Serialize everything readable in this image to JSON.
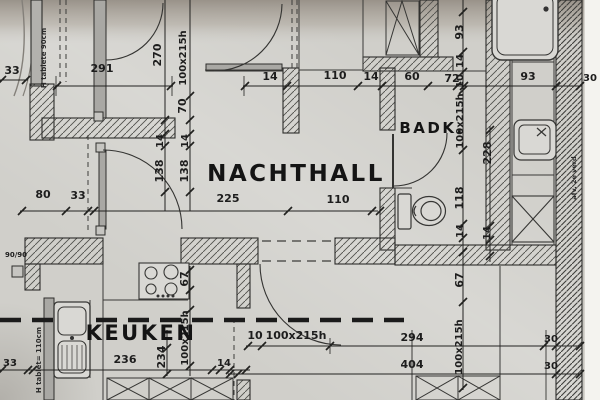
{
  "document": {
    "kind": "architectural floor plan (photo of printed drawing)",
    "colors": {
      "paper": "#d0cfca",
      "lines": "#2b2b2b",
      "shadow": "#9c978f",
      "paper_edge": "#f4f3ef"
    }
  },
  "rooms": [
    {
      "t": "NACHTHALL",
      "x": 296,
      "y": 181,
      "s": 23
    },
    {
      "t": "BADK.",
      "x": 432,
      "y": 133,
      "s": 15
    },
    {
      "t": "KEUKEN",
      "x": 141,
      "y": 340,
      "s": 21
    }
  ],
  "dimensions": [
    {
      "t": "33",
      "x": 12,
      "y": 74
    },
    {
      "t": "291",
      "x": 102,
      "y": 72
    },
    {
      "t": "270",
      "x": 161,
      "y": 55,
      "r": -90
    },
    {
      "t": "100x215h",
      "x": 186,
      "y": 58,
      "r": -90,
      "s": 10
    },
    {
      "t": "70",
      "x": 186,
      "y": 106,
      "r": -90
    },
    {
      "t": "14",
      "x": 163,
      "y": 141,
      "r": -90,
      "s": 10
    },
    {
      "t": "14",
      "x": 188,
      "y": 141,
      "r": -90,
      "s": 10
    },
    {
      "t": "138",
      "x": 163,
      "y": 171,
      "r": -90
    },
    {
      "t": "138",
      "x": 188,
      "y": 171,
      "r": -90
    },
    {
      "t": "14",
      "x": 270,
      "y": 80
    },
    {
      "t": "110",
      "x": 335,
      "y": 79
    },
    {
      "t": "14",
      "x": 371,
      "y": 80
    },
    {
      "t": "60",
      "x": 412,
      "y": 80
    },
    {
      "t": "72",
      "x": 452,
      "y": 82
    },
    {
      "t": "93",
      "x": 528,
      "y": 80
    },
    {
      "t": "30",
      "x": 590,
      "y": 81,
      "s": 10
    },
    {
      "t": "93",
      "x": 463,
      "y": 32,
      "r": -90
    },
    {
      "t": "14",
      "x": 463,
      "y": 61,
      "r": -90,
      "s": 10
    },
    {
      "t": "10",
      "x": 463,
      "y": 81,
      "r": -90,
      "s": 10
    },
    {
      "t": "100x215h",
      "x": 463,
      "y": 121,
      "r": -90,
      "s": 10
    },
    {
      "t": "228",
      "x": 491,
      "y": 153,
      "r": -90
    },
    {
      "t": "118",
      "x": 463,
      "y": 198,
      "r": -90
    },
    {
      "t": "14",
      "x": 463,
      "y": 231,
      "r": -90,
      "s": 10
    },
    {
      "t": "14",
      "x": 490,
      "y": 233,
      "r": -90,
      "s": 10
    },
    {
      "t": "80",
      "x": 43,
      "y": 198
    },
    {
      "t": "33",
      "x": 78,
      "y": 199
    },
    {
      "t": "225",
      "x": 228,
      "y": 202
    },
    {
      "t": "110",
      "x": 338,
      "y": 203
    },
    {
      "t": "67",
      "x": 463,
      "y": 280,
      "r": -90
    },
    {
      "t": "100x215h",
      "x": 462,
      "y": 347,
      "r": -90,
      "s": 10
    },
    {
      "t": "67",
      "x": 188,
      "y": 279,
      "r": -90
    },
    {
      "t": "100x215h",
      "x": 188,
      "y": 338,
      "r": -90,
      "s": 10
    },
    {
      "t": "234",
      "x": 165,
      "y": 357,
      "r": -90
    },
    {
      "t": "33",
      "x": 10,
      "y": 366,
      "s": 10
    },
    {
      "t": "236",
      "x": 125,
      "y": 363
    },
    {
      "t": "14",
      "x": 224,
      "y": 366,
      "s": 10
    },
    {
      "t": "10",
      "x": 255,
      "y": 339
    },
    {
      "t": "100x215h",
      "x": 296,
      "y": 339
    },
    {
      "t": "294",
      "x": 412,
      "y": 341
    },
    {
      "t": "30",
      "x": 551,
      "y": 342,
      "s": 10
    },
    {
      "t": "404",
      "x": 412,
      "y": 368
    },
    {
      "t": "30",
      "x": 551,
      "y": 369,
      "s": 10
    },
    {
      "t": "90/90",
      "x": 16,
      "y": 257,
      "s": 7
    }
  ],
  "notes": [
    {
      "t": "H tablete 90cm",
      "x": 46,
      "y": 58,
      "r": -90,
      "s": 7
    },
    {
      "t": "H tablet= 110cm",
      "x": 41,
      "y": 360,
      "r": -90,
      "s": 7
    },
    {
      "t": "afv. 2e verd",
      "x": 576,
      "y": 178,
      "r": -90,
      "s": 6.5
    }
  ],
  "fixtures": [
    "toilet",
    "shower-tray",
    "washbasin",
    "duct-shaft",
    "kitchen-sink",
    "stove",
    "base-cabinets",
    "tall-cabinet"
  ]
}
